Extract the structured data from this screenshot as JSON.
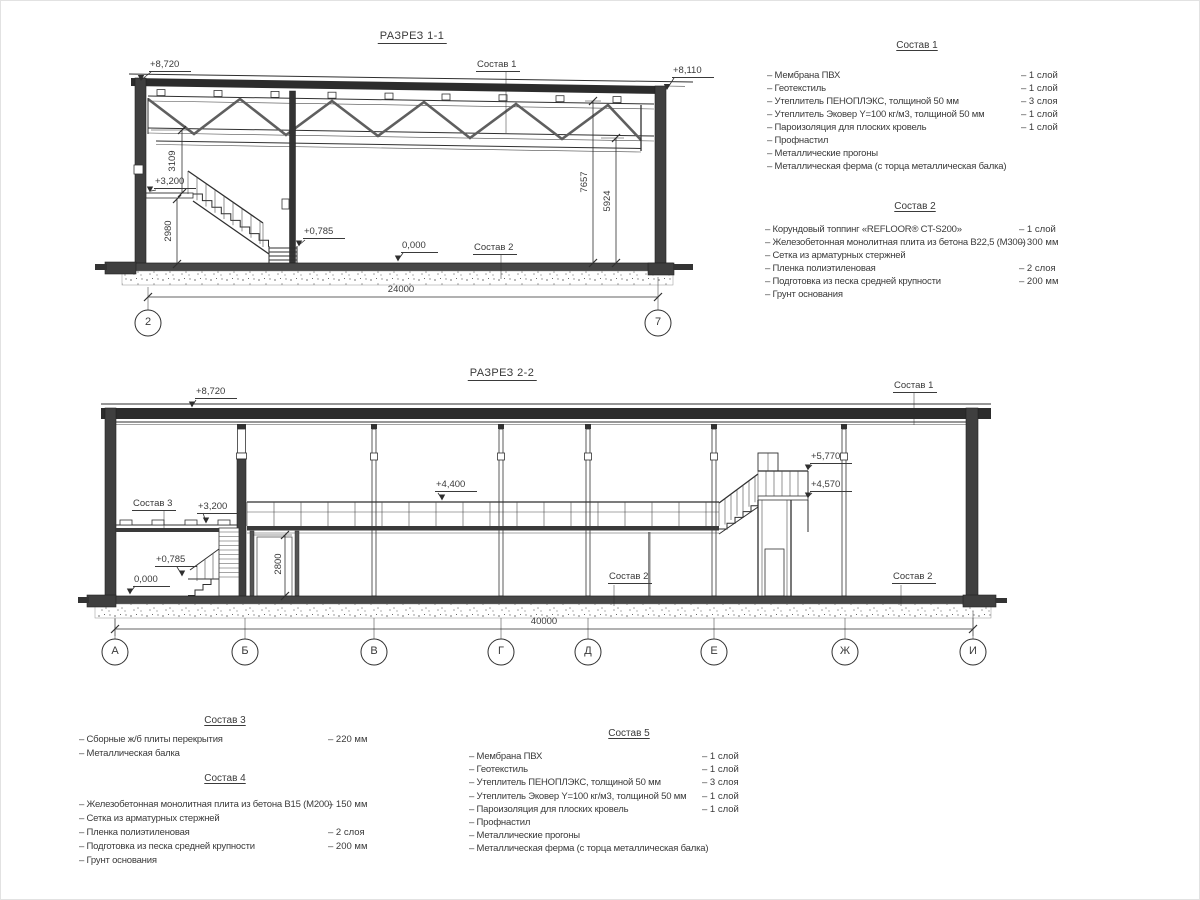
{
  "section1": {
    "title": "РАЗРЕЗ 1-1",
    "elevations": {
      "e8720": "+8,720",
      "e8110": "+8,110",
      "e3200": "+3,200",
      "e0785": "+0,785",
      "e0000": "0,000"
    },
    "refs": {
      "sostav1": "Состав 1",
      "sostav2": "Состав 2"
    },
    "dims": {
      "d3109": "3109",
      "d2980": "2980",
      "d7657": "7657",
      "d5924": "5924",
      "total": "24000"
    },
    "axes": [
      "2",
      "7"
    ]
  },
  "section2": {
    "title": "РАЗРЕЗ 2-2",
    "elevations": {
      "e8720": "+8,720",
      "e4400": "+4,400",
      "e5770": "+5,770",
      "e4570": "+4,570",
      "e3200": "+3,200",
      "e0785": "+0,785",
      "e0000": "0,000"
    },
    "refs": {
      "sostav1": "Состав 1",
      "sostav2_mid": "Состав 2",
      "sostav2_right": "Состав 2",
      "sostav3": "Состав 3"
    },
    "dims": {
      "d2800": "2800",
      "total": "40000"
    },
    "axes": [
      "А",
      "Б",
      "В",
      "Г",
      "Д",
      "Е",
      "Ж",
      "И"
    ]
  },
  "compositions": {
    "s1": {
      "title": "Состав 1",
      "items": [
        {
          "name": "– Мембрана ПВХ",
          "value": "– 1 слой"
        },
        {
          "name": "– Геотекстиль",
          "value": "– 1 слой"
        },
        {
          "name": "– Утеплитель ПЕНОПЛЭКС, толщиной 50 мм",
          "value": "– 3 слоя"
        },
        {
          "name": "– Утеплитель Эковер Y=100 кг/м3, толщиной 50 мм",
          "value": "– 1 слой"
        },
        {
          "name": "– Пароизоляция для плоских кровель",
          "value": "– 1 слой"
        },
        {
          "name": "– Профнастил",
          "value": ""
        },
        {
          "name": "– Металлические прогоны",
          "value": ""
        },
        {
          "name": "– Металлическая ферма (с торца металлическая балка)",
          "value": ""
        }
      ]
    },
    "s2": {
      "title": "Состав 2",
      "items": [
        {
          "name": "– Корундовый топпинг «REFLOOR® CT-S200»",
          "value": "– 1 слой"
        },
        {
          "name": "– Железобетонная  монолитная плита из бетона В22,5 (М300)",
          "value": "– 300 мм"
        },
        {
          "name": "– Сетка из арматурных стержней",
          "value": ""
        },
        {
          "name": "– Пленка полиэтиленовая",
          "value": "– 2 слоя"
        },
        {
          "name": "– Подготовка из песка средней крупности",
          "value": "– 200 мм"
        },
        {
          "name": "– Грунт основания",
          "value": ""
        }
      ]
    },
    "s3": {
      "title": "Состав 3",
      "items": [
        {
          "name": "– Сборные ж/б плиты перекрытия",
          "value": "– 220 мм"
        },
        {
          "name": "– Металлическая балка",
          "value": ""
        }
      ]
    },
    "s4": {
      "title": "Состав 4",
      "items": [
        {
          "name": "– Железобетонная  монолитная плита из бетона В15 (М200)",
          "value": "– 150 мм"
        },
        {
          "name": "– Сетка из арматурных стержней",
          "value": ""
        },
        {
          "name": "– Пленка полиэтиленовая",
          "value": "– 2 слоя"
        },
        {
          "name": "– Подготовка из песка средней крупности",
          "value": "– 200 мм"
        },
        {
          "name": "– Грунт основания",
          "value": ""
        }
      ]
    },
    "s5": {
      "title": "Состав 5",
      "items": [
        {
          "name": "– Мембрана ПВХ",
          "value": "– 1 слой"
        },
        {
          "name": "– Геотекстиль",
          "value": "– 1 слой"
        },
        {
          "name": "– Утеплитель ПЕНОПЛЭКС, толщиной 50 мм",
          "value": "– 3 слоя"
        },
        {
          "name": "– Утеплитель Эковер Y=100 кг/м3, толщиной 50 мм",
          "value": "– 1 слой"
        },
        {
          "name": "– Пароизоляция для плоских кровель",
          "value": "– 1 слой"
        },
        {
          "name": "– Профнастил",
          "value": ""
        },
        {
          "name": "– Металлические прогоны",
          "value": ""
        },
        {
          "name": "– Металлическая ферма (с торца металлическая балка)",
          "value": ""
        }
      ]
    }
  }
}
